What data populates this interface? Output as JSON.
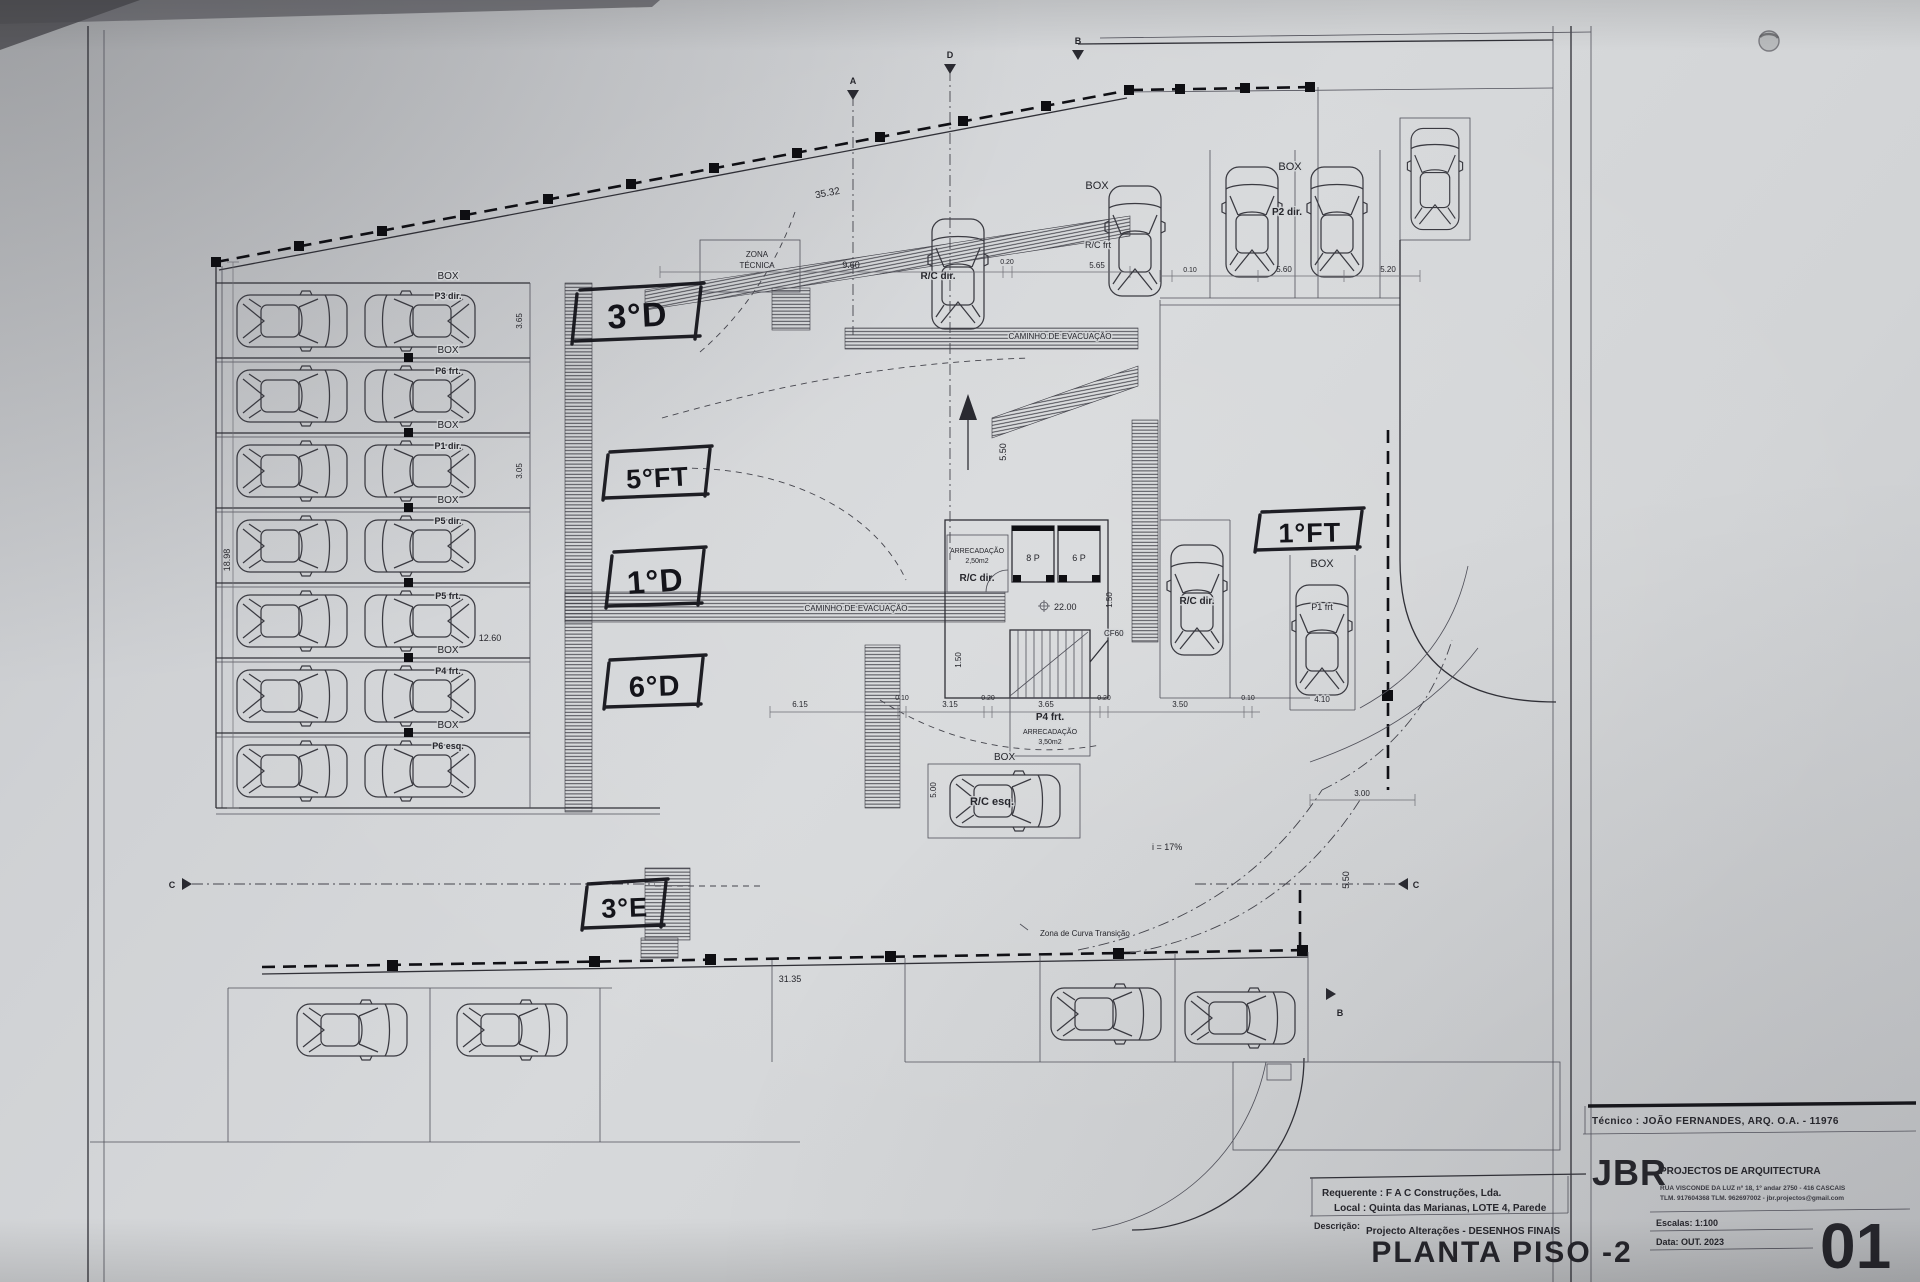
{
  "doc": {
    "tecnico": "Técnico : JOÃO FERNANDES, ARQ.   O.A. - 11976",
    "firm": "JBR",
    "firm_tag": "PROJECTOS DE ARQUITECTURA",
    "addr1": "RUA VISCONDE DA LUZ nº 18, 1º andar  2750 - 416  CASCAIS",
    "addr2": "TLM. 917604368  TLM. 962697002 - jbr.projectos@gmail.com",
    "requerente": "Requerente : F A C  Construções, Lda.",
    "local": "Local : Quinta das Marianas, LOTE 4, Parede",
    "descricao_label": "Descrição:",
    "descricao": "Projecto Alterações - DESENHOS FINAIS",
    "title": "PLANTA PISO -2",
    "escala": "Escalas:  1:100",
    "data": "Data: OUT.  2023",
    "sheet": "01"
  },
  "hand": {
    "h1": "3°D",
    "h2": "5°FT",
    "h3": "1°D",
    "h4": "6°D",
    "h5": "3°E",
    "h6": "1°FT"
  },
  "labels": {
    "box": "BOX",
    "zona1": "ZONA",
    "zona2": "TÉCNICA",
    "caminho": "CAMINHO DE EVACUAÇÃO",
    "rc_dir": "R/C dir.",
    "rc_frt": "R/C frt",
    "rc_esq": "R/C esq.",
    "p2_dir": "P2 dir.",
    "p1_frt": "P1 frt",
    "p4_frt": "P4 frt.",
    "arrec": "ARRECADAÇÃO",
    "a250": "2,50m2",
    "a350": "3,50m2",
    "e8": "8 P",
    "e6": "6 P",
    "lvl": "22.00",
    "cf": "CF60",
    "slope": "i = 17%",
    "curva": "Zona de Curva Transição"
  },
  "rows": [
    {
      "code": "P3 dir."
    },
    {
      "code": "P6 frt."
    },
    {
      "code": "P1 dir."
    },
    {
      "code": "P5 dir."
    },
    {
      "code": "P5 frt."
    },
    {
      "code": "P4 frt."
    },
    {
      "code": "P6 esq."
    }
  ],
  "dims": {
    "d3532": "35.32",
    "d960": "9.60",
    "d565": "5.65",
    "d010": "0.10",
    "d560": "5.60",
    "d520": "5.20",
    "d020": "0.20",
    "d615": "6.15",
    "d315": "3.15",
    "d365": "3.65",
    "d350": "3.50",
    "d150": "1.50",
    "d550": "5.50",
    "d500": "5.00",
    "d3135": "31.35",
    "d300": "3.00",
    "d410": "4.10",
    "d1260": "12.60",
    "d1898": "18.98",
    "d305": "3.05"
  },
  "markers": {
    "a": "A",
    "b": "B",
    "c": "C",
    "d": "D"
  }
}
